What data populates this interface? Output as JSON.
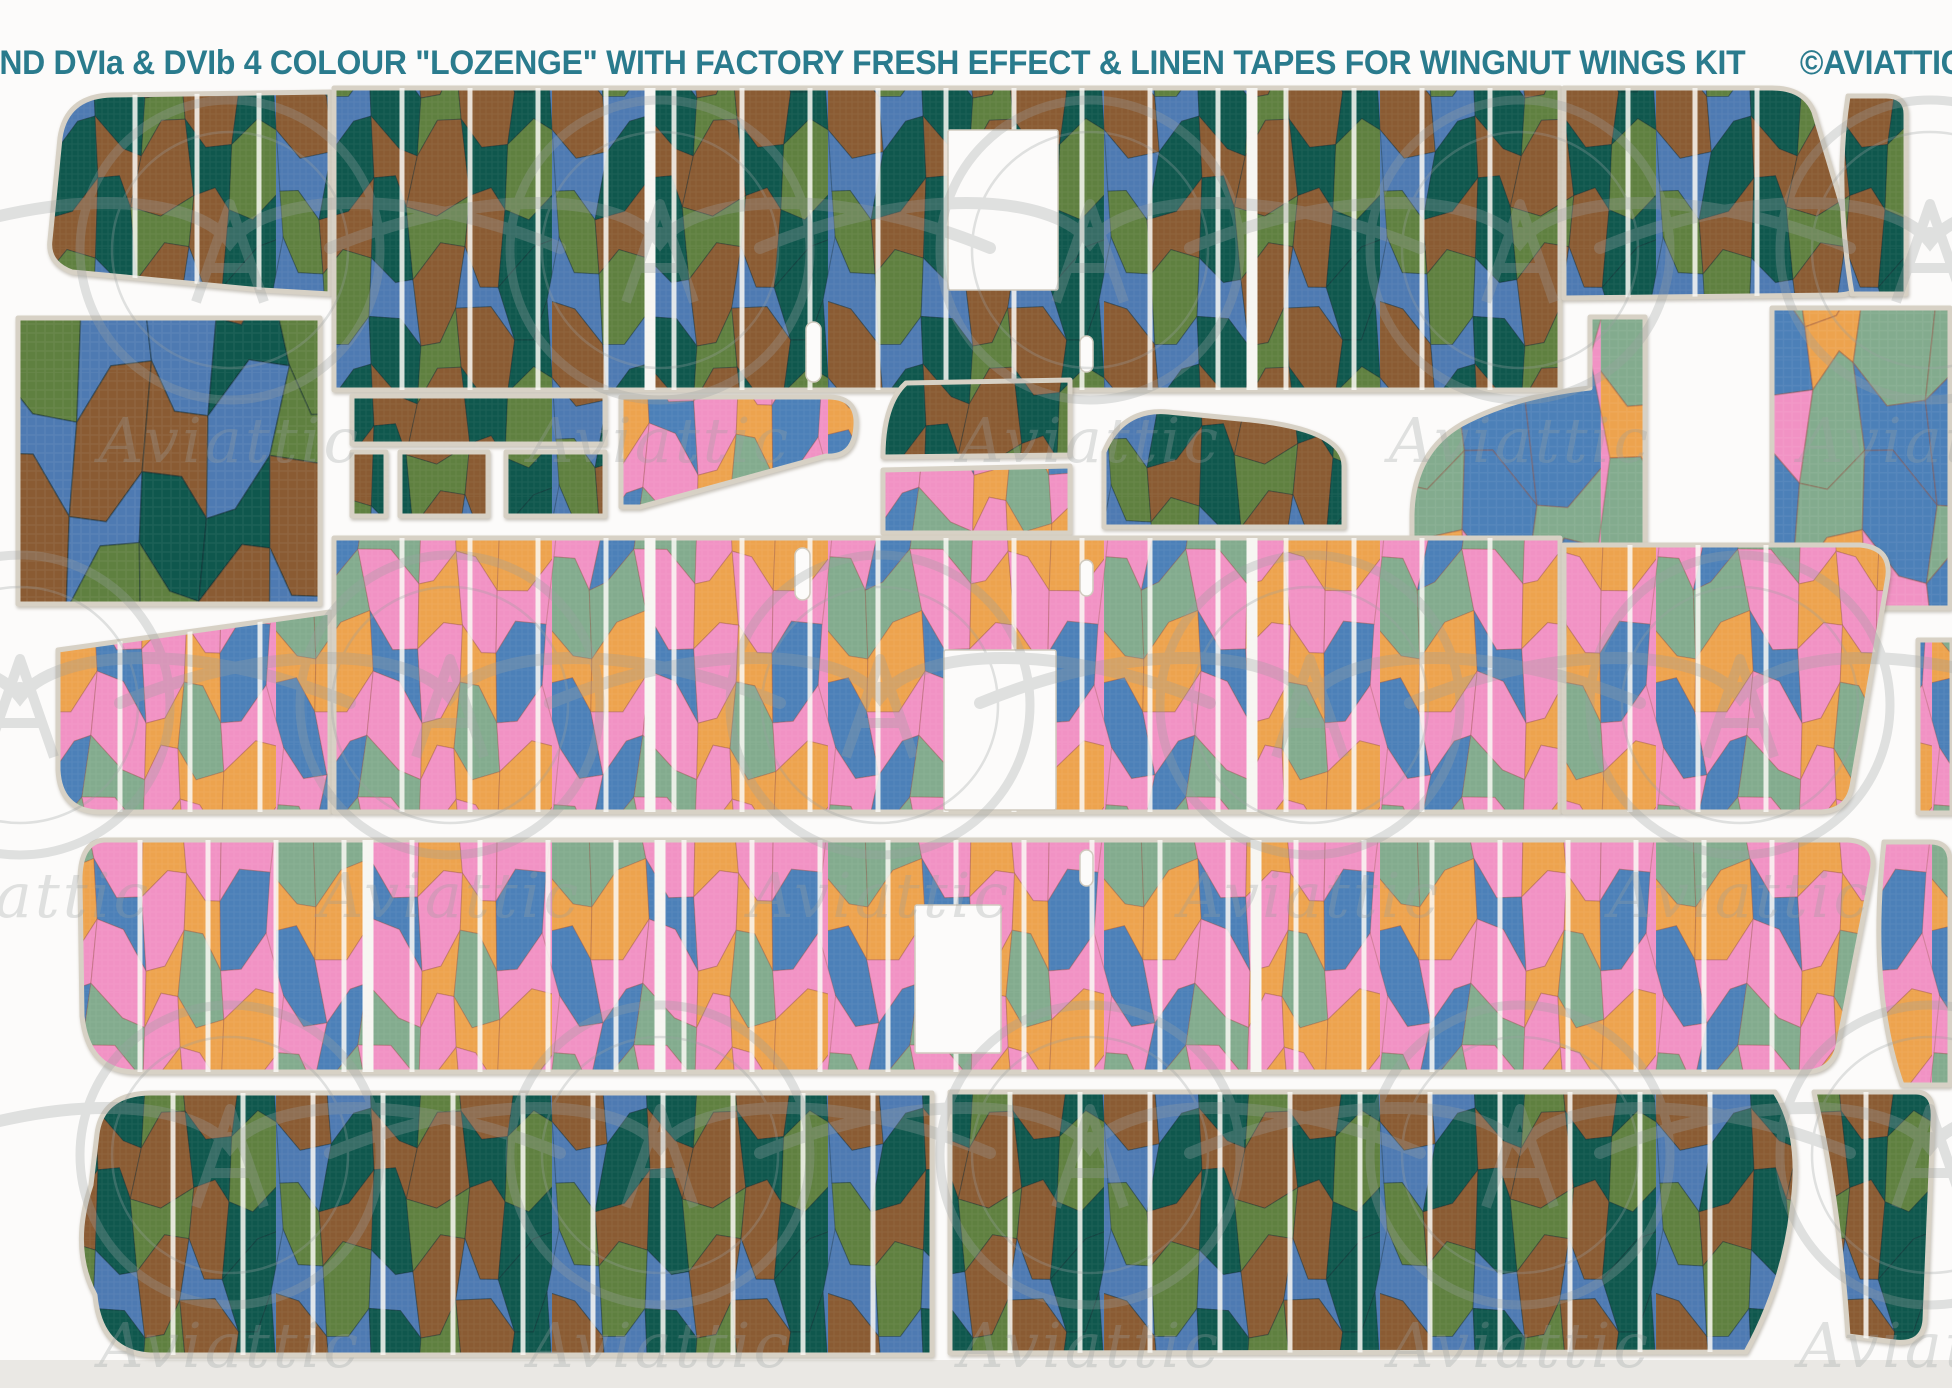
{
  "header": {
    "title": "ROLAND DVIa & DVIb  4 COLOUR \"LOZENGE\" WITH FACTORY FRESH EFFECT & LINEN TAPES FOR WINGNUT WINGS KIT",
    "copyright": "©AVIATTIC 2014",
    "text_color": "#2a7b8d"
  },
  "watermark": {
    "text": "Aviattic",
    "color": "#9aa0a0",
    "opacity": 0.3
  },
  "palettes": {
    "upper_surface_lozenge": [
      "#4e7ab2",
      "#0f574d",
      "#5f8040",
      "#8a5b33"
    ],
    "under_surface_lozenge": [
      "#f192c4",
      "#eda34e",
      "#4c80b8",
      "#83ab8e"
    ],
    "upper_cell_outline": "rgba(15,35,40,0.33)",
    "under_cell_outline": "rgba(140,75,55,0.30)",
    "rib_tape": "rgba(250,249,245,0.85)",
    "carrier_edge": "#d7d1c5",
    "background": "#fcfbfa",
    "bottom_margin": "#eae8e4"
  },
  "pieces": [
    {
      "name": "upper-lozenge-fabric-swatch",
      "pattern": "lozDarkBig",
      "rect": [
        18,
        318,
        302,
        286
      ]
    },
    {
      "name": "upper-wing-panel-top-left",
      "pattern": "lozDark",
      "d": "M112,95 Q66,96 60,138 L50,240 Q47,263 72,272 L262,290 L330,294 L330,92 Z",
      "ribs": {
        "at": [
          135,
          197,
          259
        ]
      }
    },
    {
      "name": "upper-wing-panel-top-main",
      "pattern": "lozDark",
      "rect": [
        334,
        88,
        1226,
        302
      ],
      "ribs": {
        "start": 402,
        "step": 68,
        "end": 1556
      },
      "cuts": [
        650,
        1252
      ],
      "holes": [
        {
          "t": "rect",
          "r": [
            948,
            130,
            110,
            160
          ]
        },
        {
          "t": "slot",
          "r": [
            806,
            322,
            15,
            60
          ]
        },
        {
          "t": "slot",
          "r": [
            1080,
            336,
            13,
            36
          ]
        }
      ]
    },
    {
      "name": "upper-wing-panel-top-right",
      "pattern": "lozDark",
      "d": "M1564,88 L1772,88 Q1804,88 1814,112 L1860,266 Q1868,294 1838,295 L1564,298 Z",
      "ribs": {
        "at": [
          1628,
          1695,
          1757
        ]
      }
    },
    {
      "name": "upper-wingtip-corner",
      "pattern": "lozDark",
      "d": "M1848,96 Q1834,185 1852,294 L1906,294 L1906,114 Q1906,96 1886,96 Z"
    },
    {
      "name": "upper-tape-strip",
      "pattern": "lozDark",
      "rect": [
        352,
        396,
        253,
        48
      ]
    },
    {
      "name": "upper-small-rect-1",
      "pattern": "lozDark",
      "rect": [
        352,
        452,
        34,
        64
      ]
    },
    {
      "name": "upper-small-rect-2",
      "pattern": "lozDark",
      "rect": [
        400,
        452,
        88,
        64
      ]
    },
    {
      "name": "upper-small-rect-3",
      "pattern": "lozDark",
      "rect": [
        506,
        452,
        99,
        64
      ]
    },
    {
      "name": "under-fuselage-taper",
      "pattern": "lozLight",
      "d": "M621,397 L830,397 Q857,398 856,424 Q855,458 826,456 L640,507 L621,507 Z"
    },
    {
      "name": "upper-fuselage-side",
      "pattern": "lozDark",
      "d": "M906,383 L1070,380 L1070,455 L883,457 Q883,404 906,383 Z"
    },
    {
      "name": "under-fuselage-strip",
      "pattern": "lozLight",
      "d": "M883,470 L1070,466 L1070,533 L883,533 Z"
    },
    {
      "name": "upper-fuselage-hump",
      "pattern": "lozDark",
      "d": "M1104,452 Q1122,408 1168,412 L1240,419 Q1344,428 1344,466 L1344,527 L1104,527 Z"
    },
    {
      "name": "under-wingtip-comma",
      "pattern": "lozLightBig",
      "d": "M1645,317 L1590,317 L1590,388 Q1515,396 1462,424 Q1413,452 1412,515 L1412,556 Q1413,612 1478,613 L1582,613 Q1645,610 1645,556 Z"
    },
    {
      "name": "under-fabric-rect",
      "pattern": "lozLightBig",
      "rect": [
        1772,
        308,
        178,
        300
      ]
    },
    {
      "name": "under-wing-left-row2",
      "pattern": "lozLight",
      "d": "M58,650 L330,612 L330,812 L98,812 Q60,810 58,770 Z",
      "ribs": {
        "at": [
          120,
          190,
          260
        ]
      }
    },
    {
      "name": "under-wing-main-row2",
      "pattern": "lozLight",
      "rect": [
        334,
        538,
        1226,
        274
      ],
      "ribs": {
        "start": 402,
        "step": 68,
        "end": 1556
      },
      "cuts": [
        650,
        1252
      ],
      "holes": [
        {
          "t": "rect",
          "r": [
            944,
            650,
            112,
            160
          ]
        },
        {
          "t": "slot",
          "r": [
            795,
            548,
            15,
            52
          ]
        },
        {
          "t": "slot",
          "r": [
            1080,
            560,
            13,
            36
          ]
        }
      ]
    },
    {
      "name": "under-wing-right-row2",
      "pattern": "lozLight",
      "d": "M1564,545 L1860,545 Q1894,548 1887,582 L1852,786 Q1847,812 1818,812 L1564,812 Z",
      "ribs": {
        "at": [
          1630,
          1698,
          1766
        ]
      }
    },
    {
      "name": "under-edge-sliver-row2",
      "pattern": "lozLight",
      "rect": [
        1918,
        640,
        34,
        173
      ]
    },
    {
      "name": "under-wing-main-row3",
      "pattern": "lozLight",
      "d": "M104,840 L1848,840 Q1878,842 1872,872 L1838,1046 Q1832,1072 1804,1072 L136,1072 Q88,1072 82,1016 L80,880 Q80,842 104,840 Z",
      "ribs": {
        "start": 140,
        "step": 68,
        "end": 1790
      },
      "cuts": [
        368,
        660,
        1256
      ],
      "holes": [
        {
          "t": "rect",
          "r": [
            915,
            905,
            86,
            148
          ]
        },
        {
          "t": "slot",
          "r": [
            1080,
            850,
            13,
            36
          ]
        }
      ]
    },
    {
      "name": "under-corner-row3",
      "pattern": "lozLight",
      "d": "M1884,842 L1930,842 Q1950,842 1950,862 L1950,1085 L1902,1085 Q1868,990 1884,842 Z"
    },
    {
      "name": "upper-wing-left-row4",
      "pattern": "lozDark",
      "d": "M150,1093 Q102,1094 97,1134 L91,1185 Q70,1248 95,1295 Q100,1352 150,1355 L932,1355 L932,1093 Z",
      "ribs": {
        "start": 173,
        "step": 70,
        "end": 930
      }
    },
    {
      "name": "upper-wing-right-row4",
      "pattern": "lozDark",
      "d": "M950,1092 L1775,1092 Q1803,1135 1792,1210 Q1783,1285 1746,1352 L950,1353 Z",
      "ribs": {
        "start": 1010,
        "step": 70,
        "end": 1740
      }
    },
    {
      "name": "upper-tab-row4",
      "pattern": "lozDark",
      "d": "M1814,1092 L1916,1092 Q1935,1092 1933,1120 L1925,1320 Q1923,1345 1895,1342 L1848,1336 Q1840,1215 1820,1120 Z",
      "ribs": {
        "at": [
          1866
        ]
      }
    }
  ],
  "watermark_tiles": [
    [
      230,
      250
    ],
    [
      660,
      250
    ],
    [
      1090,
      250
    ],
    [
      1520,
      250
    ],
    [
      1930,
      250
    ],
    [
      20,
      705
    ],
    [
      450,
      705
    ],
    [
      880,
      705
    ],
    [
      1310,
      705
    ],
    [
      1740,
      705
    ],
    [
      230,
      1155
    ],
    [
      660,
      1155
    ],
    [
      1090,
      1155
    ],
    [
      1520,
      1155
    ],
    [
      1930,
      1155
    ]
  ]
}
